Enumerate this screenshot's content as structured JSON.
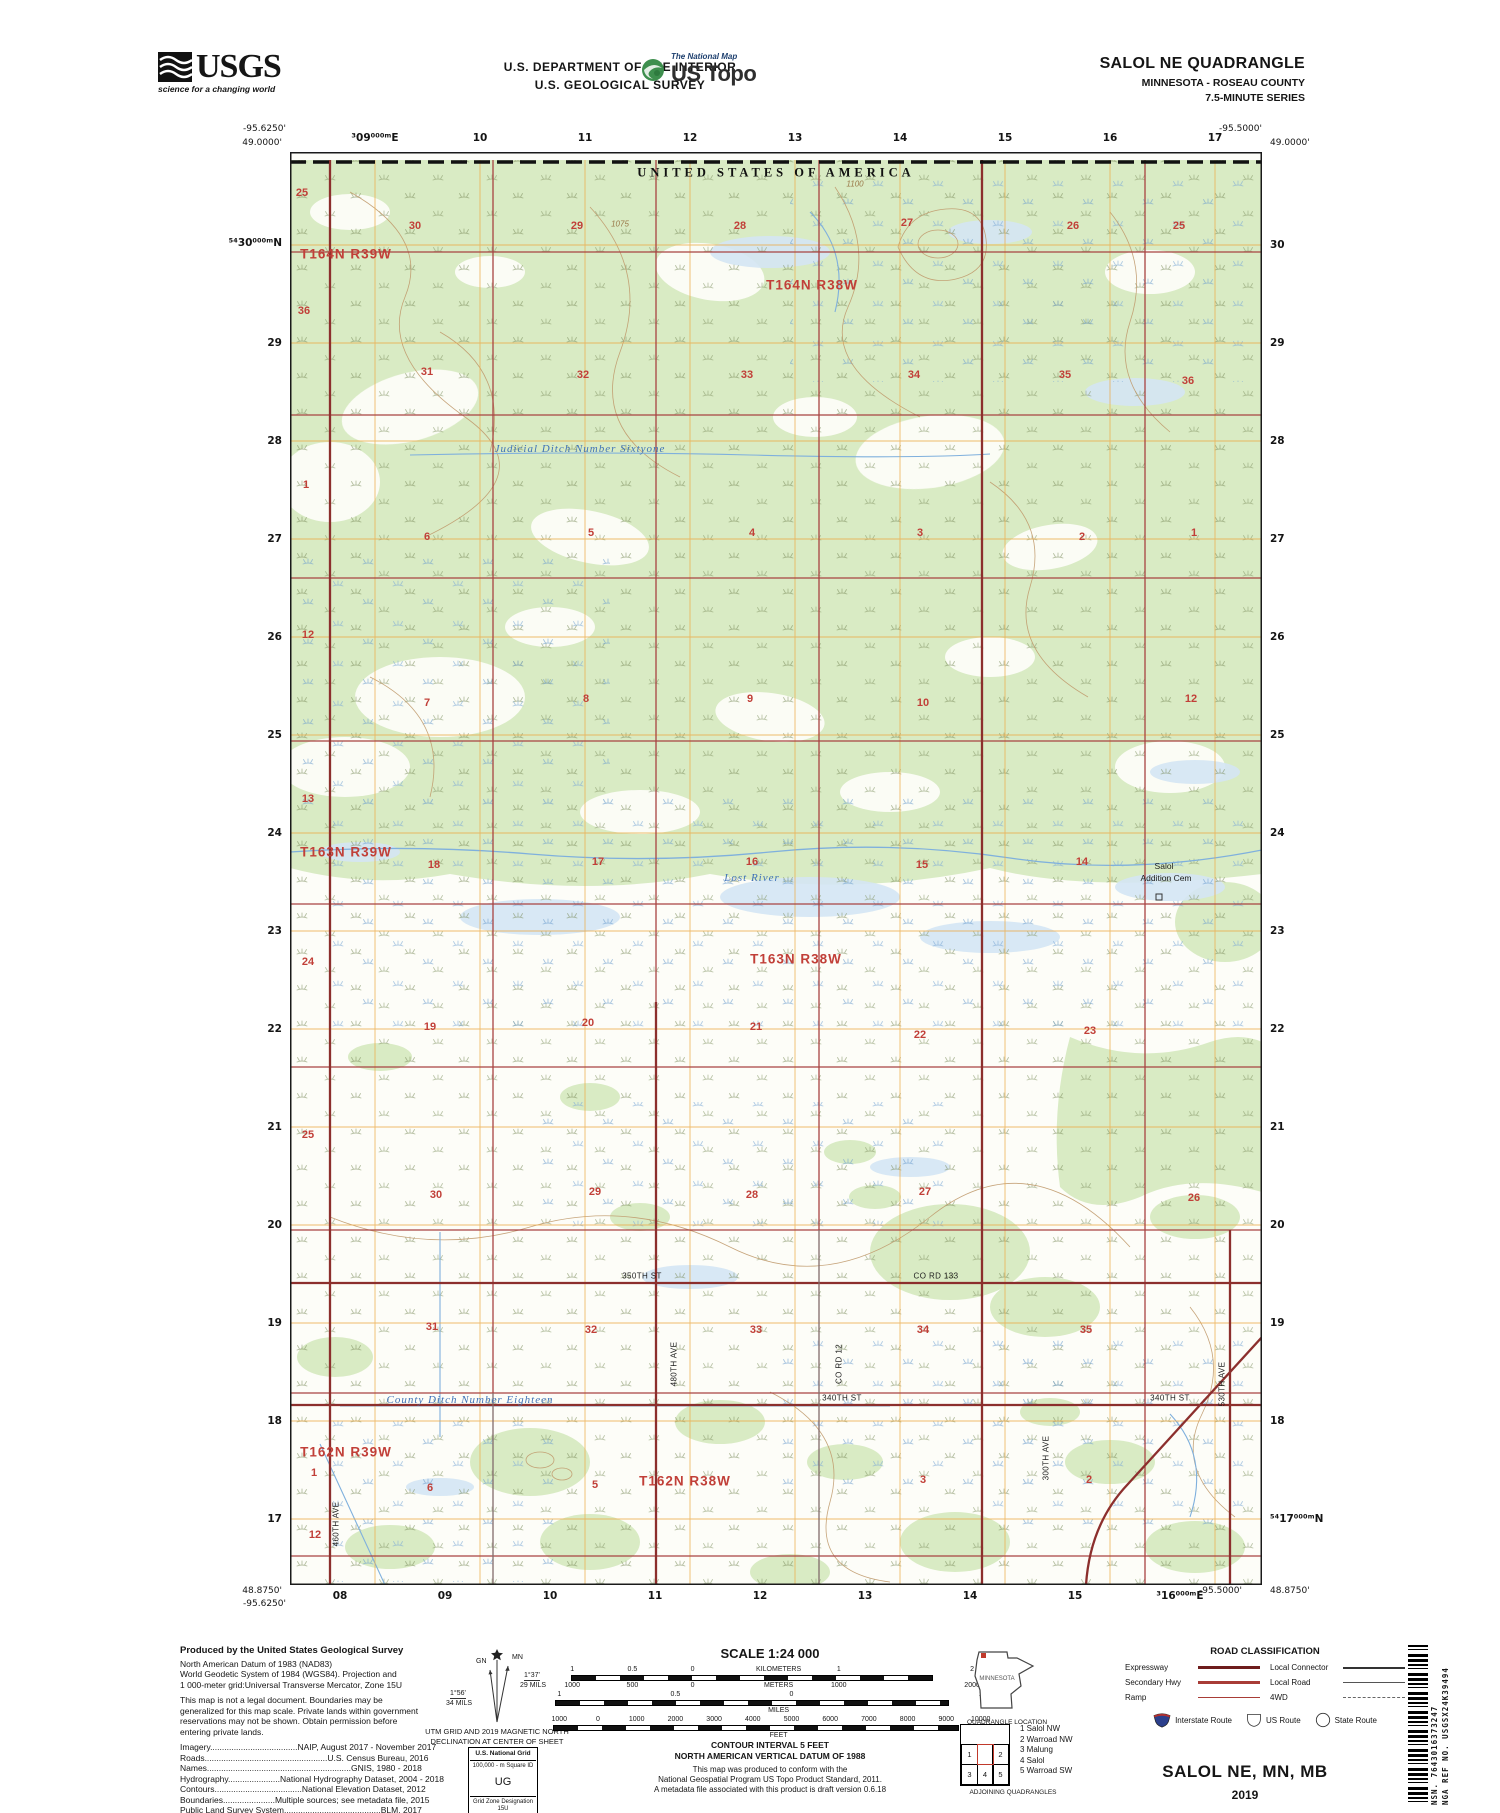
{
  "header": {
    "agency": {
      "name": "USGS",
      "tagline": "science for a changing world"
    },
    "dept_line1": "U.S. DEPARTMENT OF THE INTERIOR",
    "dept_line2": "U.S. GEOLOGICAL SURVEY",
    "ustopo": {
      "brand_top": "The National Map",
      "brand": "US Topo"
    },
    "title": "SALOL NE QUADRANGLE",
    "subtitle": "MINNESOTA - ROSEAU COUNTY",
    "series": "7.5-MINUTE SERIES"
  },
  "map": {
    "labels": {
      "usa": [
        [
          "UNITED STATES OF AMERICA",
          486,
          21
        ]
      ],
      "twp": [
        [
          "T164N R39W",
          56,
          102
        ],
        [
          "T164N R38W",
          522,
          133
        ],
        [
          "T163N R39W",
          56,
          700
        ],
        [
          "T163N R38W",
          506,
          807
        ],
        [
          "T162N R39W",
          56,
          1300
        ],
        [
          "T162N R38W",
          395,
          1329
        ]
      ],
      "sec": [
        [
          "25",
          12,
          41
        ],
        [
          "30",
          125,
          74
        ],
        [
          "29",
          287,
          74
        ],
        [
          "28",
          450,
          74
        ],
        [
          "27",
          617,
          71
        ],
        [
          "26",
          783,
          74
        ],
        [
          "25",
          889,
          74
        ],
        [
          "36",
          14,
          159
        ],
        [
          "31",
          137,
          220
        ],
        [
          "32",
          293,
          223
        ],
        [
          "33",
          457,
          223
        ],
        [
          "34",
          624,
          223
        ],
        [
          "35",
          775,
          223
        ],
        [
          "36",
          898,
          229
        ],
        [
          "1",
          16,
          333
        ],
        [
          "6",
          137,
          385
        ],
        [
          "5",
          301,
          381
        ],
        [
          "4",
          462,
          381
        ],
        [
          "3",
          630,
          381
        ],
        [
          "2",
          792,
          385
        ],
        [
          "1",
          904,
          381
        ],
        [
          "12",
          18,
          483
        ],
        [
          "7",
          137,
          551
        ],
        [
          "8",
          296,
          547
        ],
        [
          "9",
          460,
          547
        ],
        [
          "10",
          633,
          551
        ],
        [
          "12",
          901,
          547
        ],
        [
          "13",
          18,
          647
        ],
        [
          "18",
          144,
          713
        ],
        [
          "17",
          308,
          710
        ],
        [
          "16",
          462,
          710
        ],
        [
          "15",
          632,
          713
        ],
        [
          "14",
          792,
          710
        ],
        [
          "24",
          18,
          810
        ],
        [
          "19",
          140,
          875
        ],
        [
          "20",
          298,
          871
        ],
        [
          "21",
          466,
          875
        ],
        [
          "22",
          630,
          883
        ],
        [
          "23",
          800,
          879
        ],
        [
          "25",
          18,
          983
        ],
        [
          "30",
          146,
          1043
        ],
        [
          "29",
          305,
          1040
        ],
        [
          "28",
          462,
          1043
        ],
        [
          "27",
          635,
          1040
        ],
        [
          "26",
          904,
          1046
        ],
        [
          "31",
          142,
          1175
        ],
        [
          "32",
          301,
          1178
        ],
        [
          "33",
          466,
          1178
        ],
        [
          "34",
          633,
          1178
        ],
        [
          "35",
          796,
          1178
        ],
        [
          "1",
          24,
          1321
        ],
        [
          "6",
          140,
          1336
        ],
        [
          "5",
          305,
          1333
        ],
        [
          "3",
          633,
          1328
        ],
        [
          "2",
          799,
          1328
        ],
        [
          "12",
          25,
          1383
        ]
      ],
      "wat": [
        [
          "Judicial Ditch Number Sixtyone",
          290,
          297
        ],
        [
          "Lost River",
          462,
          726
        ],
        [
          "County Ditch Number Eighteen",
          180,
          1248
        ]
      ],
      "rd": [
        [
          "350TH ST",
          352,
          1124,
          0
        ],
        [
          "CO RD 133",
          646,
          1124,
          0
        ],
        [
          "340TH ST",
          552,
          1246,
          0
        ],
        [
          "340TH ST",
          880,
          1246,
          0
        ],
        [
          "460TH AVE",
          46,
          1372,
          -90
        ],
        [
          "480TH AVE",
          384,
          1212,
          -90
        ],
        [
          "CO RD 12",
          549,
          1212,
          -90
        ],
        [
          "300TH AVE",
          756,
          1306,
          -90
        ],
        [
          "530TH AVE",
          932,
          1232,
          -90
        ]
      ],
      "plc": [
        [
          "Salol",
          874,
          714
        ],
        [
          "Addition Cem",
          876,
          726
        ]
      ],
      "ctr": [
        [
          "1100",
          565,
          32
        ],
        [
          "1075",
          330,
          72
        ]
      ]
    },
    "edge_labels": [
      [
        "-95.6250'",
        286,
        129,
        "coord a-r"
      ],
      [
        "49.0000'",
        282,
        143,
        "coord a-r"
      ],
      [
        "-95.5000'",
        1262,
        129,
        "coord a-r"
      ],
      [
        "49.0000'",
        1270,
        143,
        "coord a-l"
      ],
      [
        "48.8750'",
        282,
        1591,
        "coord a-r"
      ],
      [
        "-95.6250'",
        286,
        1604,
        "coord a-r"
      ],
      [
        "-95.5000'",
        1242,
        1591,
        "coord a-r"
      ],
      [
        "48.8750'",
        1270,
        1591,
        "coord a-l"
      ],
      [
        "⁵⁴30⁰⁰⁰ᵐN",
        282,
        243,
        "gnum a-r"
      ],
      [
        "³09⁰⁰⁰ᵐE",
        375,
        138,
        "gnum a-c"
      ],
      [
        "10",
        480,
        138,
        "gnum a-c"
      ],
      [
        "11",
        585,
        138,
        "gnum a-c"
      ],
      [
        "12",
        690,
        138,
        "gnum a-c"
      ],
      [
        "13",
        795,
        138,
        "gnum a-c"
      ],
      [
        "14",
        900,
        138,
        "gnum a-c"
      ],
      [
        "15",
        1005,
        138,
        "gnum a-c"
      ],
      [
        "16",
        1110,
        138,
        "gnum a-c"
      ],
      [
        "17",
        1215,
        138,
        "gnum a-c"
      ],
      [
        "08",
        340,
        1596,
        "gnum a-c"
      ],
      [
        "09",
        445,
        1596,
        "gnum a-c"
      ],
      [
        "10",
        550,
        1596,
        "gnum a-c"
      ],
      [
        "11",
        655,
        1596,
        "gnum a-c"
      ],
      [
        "12",
        760,
        1596,
        "gnum a-c"
      ],
      [
        "13",
        865,
        1596,
        "gnum a-c"
      ],
      [
        "14",
        970,
        1596,
        "gnum a-c"
      ],
      [
        "15",
        1075,
        1596,
        "gnum a-c"
      ],
      [
        "³16⁰⁰⁰ᵐE",
        1180,
        1596,
        "gnum a-c"
      ],
      [
        "29",
        282,
        343,
        "gnum a-r"
      ],
      [
        "28",
        282,
        441,
        "gnum a-r"
      ],
      [
        "27",
        282,
        539,
        "gnum a-r"
      ],
      [
        "26",
        282,
        637,
        "gnum a-r"
      ],
      [
        "25",
        282,
        735,
        "gnum a-r"
      ],
      [
        "24",
        282,
        833,
        "gnum a-r"
      ],
      [
        "23",
        282,
        931,
        "gnum a-r"
      ],
      [
        "22",
        282,
        1029,
        "gnum a-r"
      ],
      [
        "21",
        282,
        1127,
        "gnum a-r"
      ],
      [
        "20",
        282,
        1225,
        "gnum a-r"
      ],
      [
        "19",
        282,
        1323,
        "gnum a-r"
      ],
      [
        "18",
        282,
        1421,
        "gnum a-r"
      ],
      [
        "17",
        282,
        1519,
        "gnum a-r"
      ],
      [
        "30",
        1270,
        245,
        "gnum a-l"
      ],
      [
        "29",
        1270,
        343,
        "gnum a-l"
      ],
      [
        "28",
        1270,
        441,
        "gnum a-l"
      ],
      [
        "27",
        1270,
        539,
        "gnum a-l"
      ],
      [
        "26",
        1270,
        637,
        "gnum a-l"
      ],
      [
        "25",
        1270,
        735,
        "gnum a-l"
      ],
      [
        "24",
        1270,
        833,
        "gnum a-l"
      ],
      [
        "23",
        1270,
        931,
        "gnum a-l"
      ],
      [
        "22",
        1270,
        1029,
        "gnum a-l"
      ],
      [
        "21",
        1270,
        1127,
        "gnum a-l"
      ],
      [
        "20",
        1270,
        1225,
        "gnum a-l"
      ],
      [
        "19",
        1270,
        1323,
        "gnum a-l"
      ],
      [
        "18",
        1270,
        1421,
        "gnum a-l"
      ],
      [
        "⁵⁴17⁰⁰⁰ᵐN",
        1270,
        1519,
        "gnum a-l"
      ]
    ]
  },
  "footer": {
    "produced_title": "Produced by the United States Geological Survey",
    "datum_lines": [
      "North American Datum of 1983 (NAD83)",
      "World Geodetic System of 1984 (WGS84).  Projection and",
      "1 000-meter grid:Universal Transverse Mercator, Zone 15U"
    ],
    "legal_lines": [
      "This map is not a legal document. Boundaries may be",
      "generalized for this map scale. Private lands within government",
      "reservations may not be shown. Obtain permission before",
      "entering private lands."
    ],
    "sources": [
      "Imagery.....................................NAIP, August 2017 - November 2017",
      "Roads....................................................U.S. Census Bureau, 2016",
      "Names.............................................................GNIS, 1980 - 2018",
      "Hydrography......................National Hydrography Dataset, 2004 - 2018",
      "Contours.....................................National Elevation Dataset, 2012",
      "Boundaries......................Multiple sources; see metadata file, 2015",
      "Public Land Survey System.........................................BLM, 2017",
      "Wetlands........................FWS National Wetlands Inventory, 1982 - 1983"
    ],
    "declination": {
      "gn": "GN",
      "mn": "MN",
      "left_deg": "1°56'",
      "left_mils": "34 MILS",
      "right_deg": "1°37'",
      "right_mils": "29 MILS",
      "caption1": "UTM GRID AND 2019 MAGNETIC NORTH",
      "caption2": "DECLINATION AT CENTER OF SHEET"
    },
    "usng": {
      "title": "U.S. National Grid",
      "sq": "100,000 - m Square ID",
      "id": "UG",
      "gzd_label": "Grid Zone Designation",
      "gzd": "15U"
    },
    "scale_title": "SCALE 1:24 000",
    "bars": [
      {
        "type": "labels",
        "items": [
          [
            "1",
            4
          ],
          [
            "0.5",
            18
          ],
          [
            "0",
            32
          ],
          [
            "KILOMETERS",
            52
          ],
          [
            "1",
            66
          ],
          [
            "2",
            97
          ]
        ]
      },
      {
        "type": "bar",
        "cls": "bar-km"
      },
      {
        "type": "labels",
        "items": [
          [
            "1000",
            4
          ],
          [
            "500",
            18
          ],
          [
            "0",
            32
          ],
          [
            "METERS",
            52
          ],
          [
            "1000",
            66
          ],
          [
            "2000",
            97
          ]
        ]
      },
      {
        "type": "labels",
        "items": [
          [
            "1",
            1
          ],
          [
            "0.5",
            28
          ],
          [
            "0",
            55
          ],
          [
            "1",
            99
          ]
        ]
      },
      {
        "type": "bar",
        "cls": "bar-mi"
      },
      {
        "type": "labels",
        "items": [
          [
            "MILES",
            52
          ]
        ]
      },
      {
        "type": "labels",
        "items": [
          [
            "1000",
            1
          ],
          [
            "0",
            10
          ],
          [
            "1000",
            19
          ],
          [
            "2000",
            28
          ],
          [
            "3000",
            37
          ],
          [
            "4000",
            46
          ],
          [
            "5000",
            55
          ],
          [
            "6000",
            64
          ],
          [
            "7000",
            73
          ],
          [
            "8000",
            82
          ],
          [
            "9000",
            91
          ],
          [
            "10000",
            99
          ]
        ]
      },
      {
        "type": "bar",
        "cls": "bar-ft"
      },
      {
        "type": "labels",
        "items": [
          [
            "FEET",
            52
          ]
        ]
      }
    ],
    "contour_line1": "CONTOUR INTERVAL 5 FEET",
    "contour_line2": "NORTH AMERICAN VERTICAL DATUM OF 1988",
    "conform_lines": [
      "This map was produced to conform with the",
      "National Geospatial Program US Topo Product Standard, 2011.",
      "A metadata file associated with this product is draft version 0.6.18"
    ],
    "quad_location": {
      "state": "MINNESOTA",
      "caption": "QUADRANGLE LOCATION"
    },
    "adjoining": {
      "cells": [
        "1",
        "2",
        "3",
        "4",
        "5"
      ],
      "list": [
        "1 Salol NW",
        "2 Warroad NW",
        "3 Malung",
        "4 Salol",
        "5 Warroad SW"
      ],
      "caption": "ADJOINING QUADRANGLES"
    },
    "road_class": {
      "title": "ROAD CLASSIFICATION",
      "rows_left": [
        {
          "label": "Expressway"
        },
        {
          "label": "Secondary Hwy"
        },
        {
          "label": "Ramp"
        }
      ],
      "rows_right": [
        {
          "label": "Local Connector"
        },
        {
          "label": "Local Road"
        },
        {
          "label": "4WD"
        }
      ],
      "shields": [
        {
          "label": "Interstate Route"
        },
        {
          "label": "US Route"
        },
        {
          "label": "State Route"
        }
      ]
    },
    "map_name": "SALOL NE, MN, MB",
    "year": "2019",
    "barcode": {
      "nsn": "NSN.  7643016373247",
      "nga": "NGA REF NO.  USGSX24K39494"
    }
  },
  "colors": {
    "woodland_green": "#d9ebc4",
    "wet_blue": "#d4e6f4",
    "grid_orange": "#ecaa48",
    "section_red": "#a84342",
    "road_red": "#8c2f2d",
    "contour_brown": "#c09a6d",
    "label_red": "#c13f38",
    "water_blue": "#3f72b8"
  }
}
